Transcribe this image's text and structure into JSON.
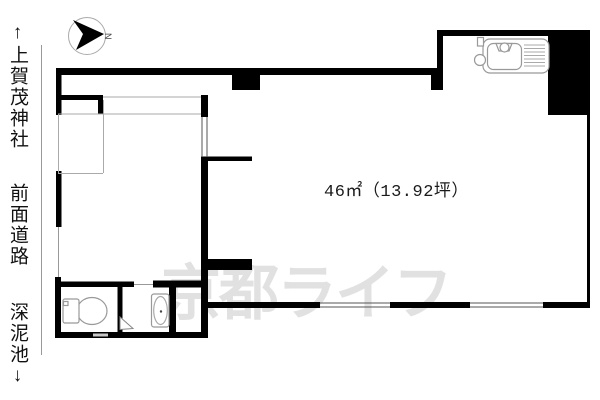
{
  "floorplan": {
    "area_label": "46㎡（13.92坪）",
    "watermark": "京都ライフ",
    "compass": {
      "label": "N"
    },
    "side_labels": {
      "top": "↑上賀茂神社",
      "middle": "前面道路",
      "bottom": "深泥池↓"
    },
    "fixtures": [
      "kitchen-sink",
      "toilet",
      "bathtub",
      "door-swing"
    ],
    "colors": {
      "wall": "#000000",
      "fixture_line": "#999999",
      "thin_line": "#aaaaaa",
      "road_line": "#999999",
      "watermark": "#e1e1e1"
    }
  }
}
